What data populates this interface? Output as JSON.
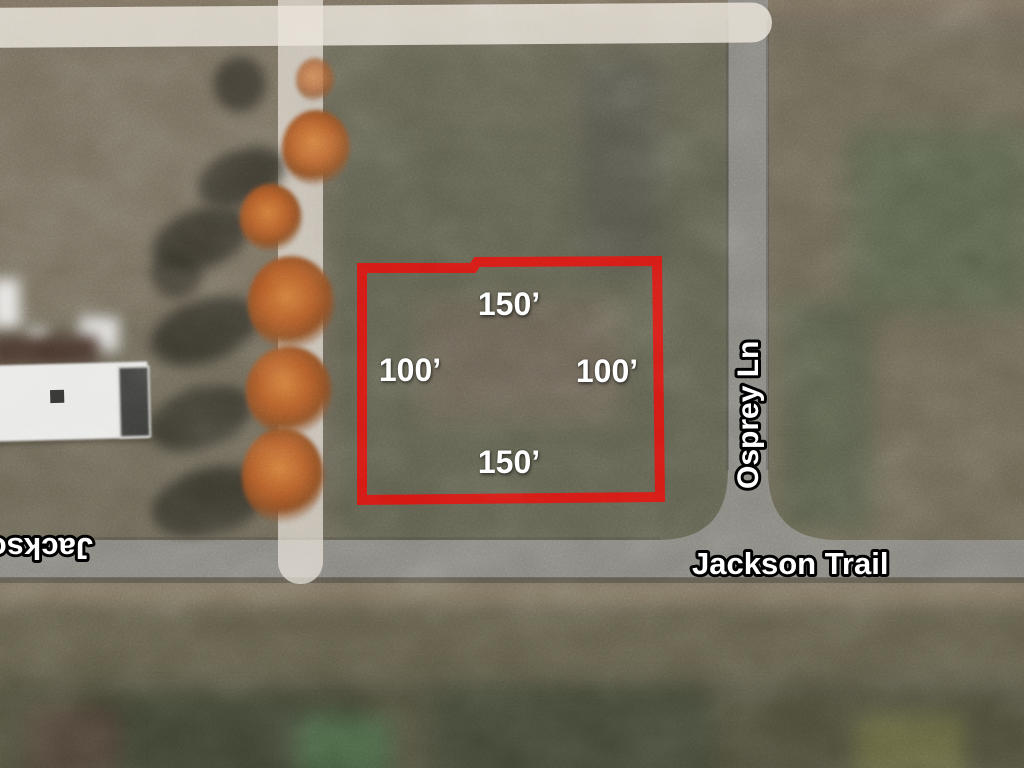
{
  "map": {
    "parcel": {
      "outline_color": "#d31712",
      "dimensions": {
        "top": "150’",
        "left": "100’",
        "right": "100’",
        "bottom": "150’"
      }
    },
    "streets": {
      "jackson_trail": "Jackson Trail",
      "osprey_ln": "Osprey Ln",
      "jackson_trail_flipped_partial": "Jackso"
    },
    "colors": {
      "road_gray": "#87867f",
      "route_overlay_white": "#ece6db",
      "parcel_red": "#d31712"
    }
  }
}
